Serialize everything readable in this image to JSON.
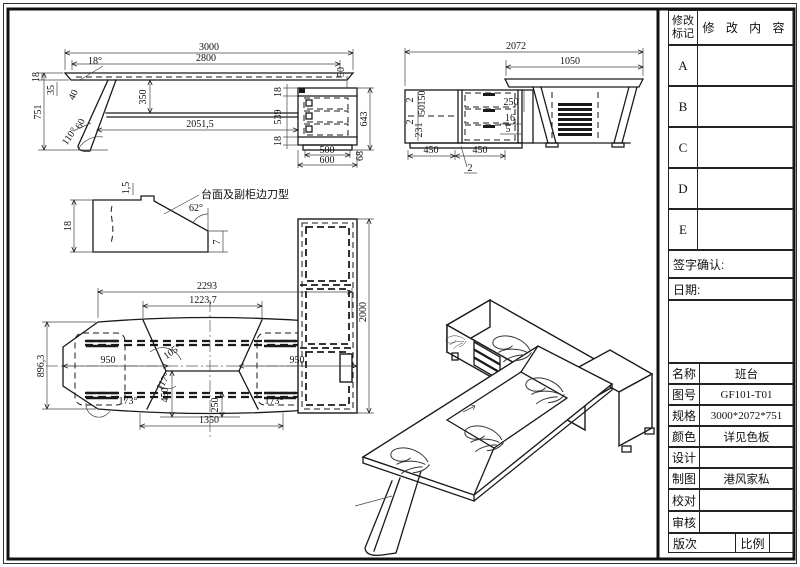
{
  "sheet": {
    "background": "#ffffff",
    "line_color": "#1a1a1a"
  },
  "revision_table": {
    "mark_header_line1": "修改",
    "mark_header_line2": "标记",
    "content_header": "修 改 内 容",
    "rows": [
      "A",
      "B",
      "C",
      "D",
      "E"
    ],
    "sign_label": "签字确认:",
    "date_label": "日期:"
  },
  "info_table": {
    "rows": [
      {
        "label": "名称",
        "value": "班台"
      },
      {
        "label": "图号",
        "value": "GF101-T01"
      },
      {
        "label": "规格",
        "value": "3000*2072*751"
      },
      {
        "label": "颜色",
        "value": "详见色板"
      },
      {
        "label": "设计",
        "value": ""
      },
      {
        "label": "制图",
        "value": "港风家私"
      },
      {
        "label": "校对",
        "value": ""
      },
      {
        "label": "审核",
        "value": ""
      }
    ],
    "footer_left": "版次",
    "footer_right": "比例"
  },
  "views": {
    "front": {
      "overall_width": "3000",
      "top_width": "2800",
      "top_thickness": "18",
      "edge_angle": "18°",
      "drop_35": "35",
      "leg_top_40": "40",
      "height_751": "751",
      "panel_drop_350": "350",
      "leg_thick_60": "60",
      "leg_angle_110": "110°",
      "span_2051_5": "2051,5",
      "rail_top_18": "18",
      "drawer_zone_539": "539",
      "rail_bottom_18": "18",
      "ped_height_643": "643",
      "gap_50": "50",
      "ped_inner_500": "500",
      "ped_width_600": "600",
      "plinth_68": "68"
    },
    "side": {
      "overall_2072": "2072",
      "top_1050": "1050",
      "gap_2a": "2",
      "front_150": "150",
      "rail_50": "50",
      "gap_2b": "2",
      "door_231": "231",
      "clear_250": "250",
      "rail_16": "16",
      "gap_5": "5",
      "door_450a": "450",
      "door_450b": "450",
      "edge_2": "2"
    },
    "detail": {
      "callout": "台面及副柜边刀型",
      "lip_1_5": "1,5",
      "thick_18": "18",
      "angle_62": "62°",
      "tip_7": "7"
    },
    "plan": {
      "span_2293": "2293",
      "center_1223_7": "1223,7",
      "depth_896_3": "896,3",
      "left_950": "950",
      "right_950": "950",
      "angle_105": "105°",
      "angle_117": "117°",
      "angle_173l": "173°",
      "angle_173r": "173°",
      "v_450": "450",
      "v_250": "250",
      "bottom_1350": "1350",
      "cabinet_2000": "2000"
    }
  }
}
